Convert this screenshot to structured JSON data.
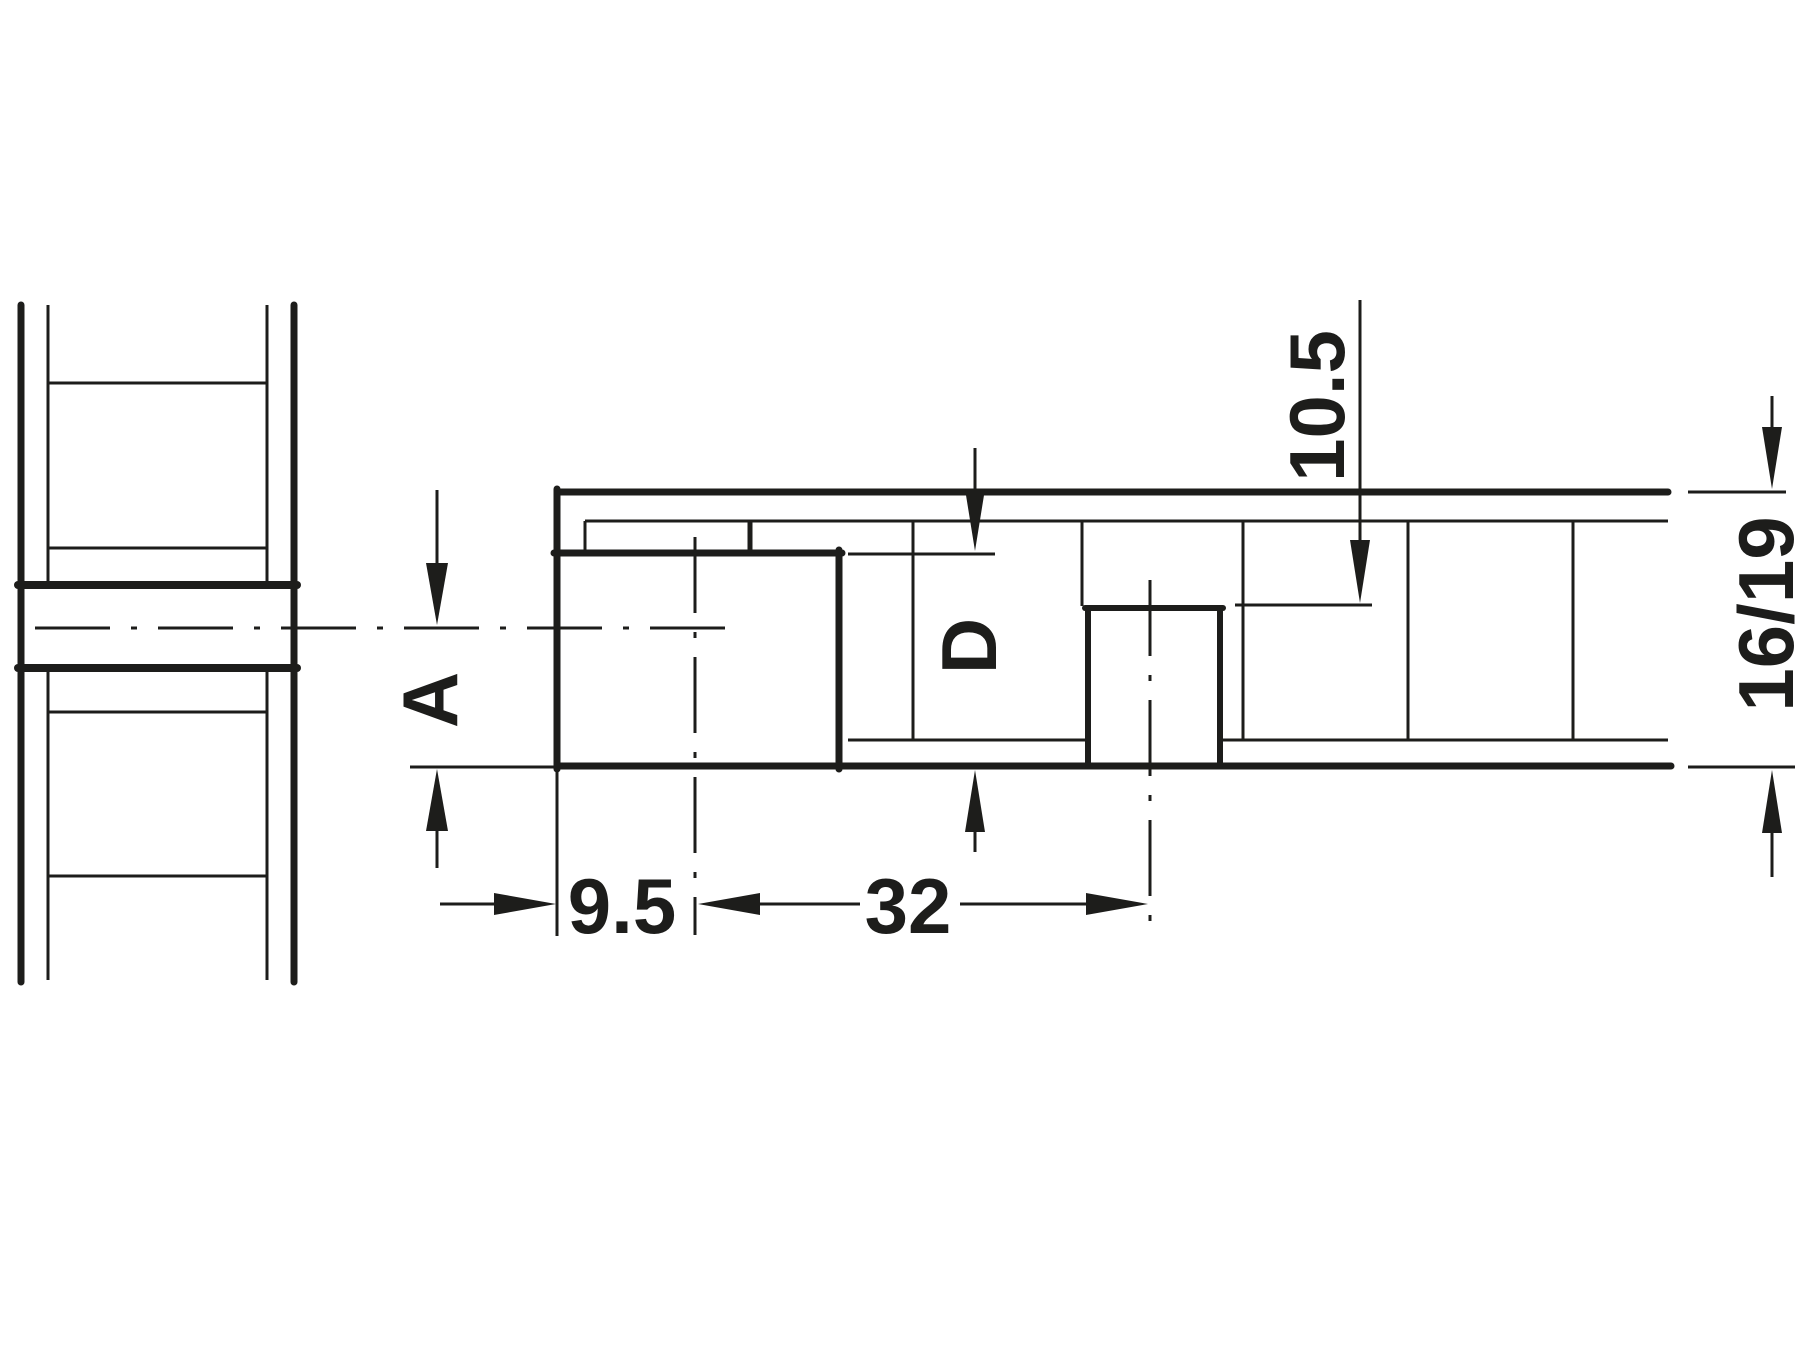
{
  "drawing": {
    "title": "fitting-drilling-dimensions-technical-drawing",
    "line_color": "#1d1d1b",
    "background_color": "#ffffff",
    "labels": {
      "distance_a": "A",
      "edge_distance": "9.5",
      "hole_spacing": "32",
      "drill_diameter_d": "D",
      "drilling_depth": "10.5",
      "panel_thickness": "16/19"
    }
  }
}
